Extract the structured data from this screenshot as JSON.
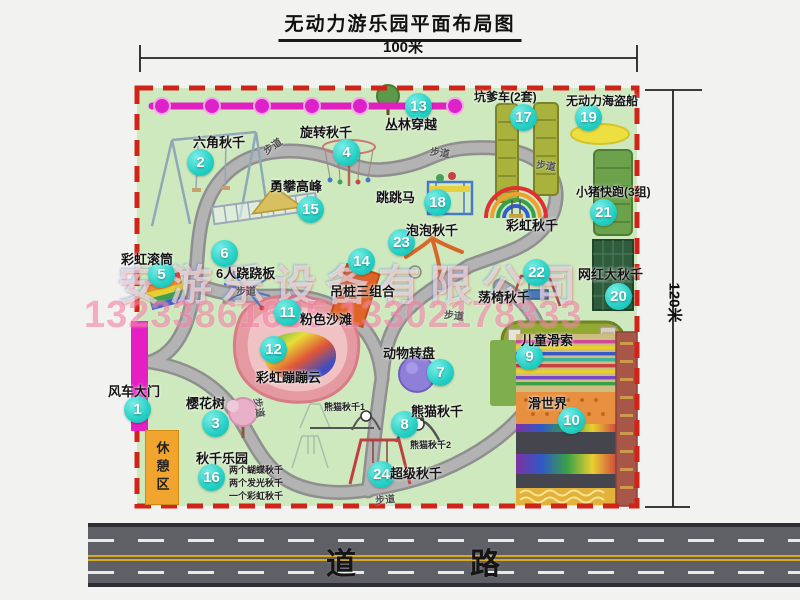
{
  "title": "无动力游乐园平面布局图",
  "dimensions": {
    "width": "100米",
    "height": "120米"
  },
  "road": {
    "label": "道　　路"
  },
  "rest_area": {
    "label": "休憩区"
  },
  "walkway_label": "步道",
  "watermark": {
    "company": "安游乐设备有限公司",
    "phone": "13233861635 13302178333"
  },
  "swing_park_notes": [
    "两个蝴蝶秋千",
    "两个发光秋千",
    "一个彩虹秋千"
  ],
  "panda_sub_labels": [
    "熊猫秋千1",
    "熊猫秋千2"
  ],
  "attractions": [
    {
      "num": "1",
      "name": "风车大门",
      "badge": [
        137,
        409
      ],
      "label": [
        108,
        381
      ]
    },
    {
      "num": "2",
      "name": "六角秋千",
      "badge": [
        200,
        162
      ],
      "label": [
        193,
        132
      ]
    },
    {
      "num": "3",
      "name": "樱花树",
      "badge": [
        215,
        423
      ],
      "label": [
        186,
        393
      ]
    },
    {
      "num": "4",
      "name": "旋转秋千",
      "badge": [
        346,
        152
      ],
      "label": [
        300,
        122
      ]
    },
    {
      "num": "5",
      "name": "彩虹滚筒",
      "badge": [
        161,
        274
      ],
      "label": [
        121,
        249
      ]
    },
    {
      "num": "6",
      "name": "6人跷跷板",
      "badge": [
        224,
        253
      ],
      "label": [
        216,
        263
      ]
    },
    {
      "num": "7",
      "name": "动物转盘",
      "badge": [
        440,
        372
      ],
      "label": [
        383,
        343
      ]
    },
    {
      "num": "8",
      "name": "熊猫秋千",
      "badge": [
        404,
        424
      ],
      "label": [
        411,
        401
      ]
    },
    {
      "num": "9",
      "name": "儿童滑索",
      "badge": [
        529,
        356
      ],
      "label": [
        521,
        330
      ]
    },
    {
      "num": "10",
      "name": "滑世界",
      "badge": [
        571,
        420
      ],
      "label": [
        528,
        393
      ]
    },
    {
      "num": "11",
      "name": "粉色沙滩",
      "badge": [
        287,
        312
      ],
      "label": [
        300,
        309
      ]
    },
    {
      "num": "12",
      "name": "彩虹蹦蹦云",
      "badge": [
        273,
        349
      ],
      "label": [
        256,
        367
      ]
    },
    {
      "num": "13",
      "name": "丛林穿越",
      "badge": [
        418,
        106
      ],
      "label": [
        385,
        114
      ]
    },
    {
      "num": "14",
      "name": "吊桩三组合",
      "badge": [
        361,
        261
      ],
      "label": [
        330,
        281
      ]
    },
    {
      "num": "15",
      "name": "勇攀高峰",
      "badge": [
        310,
        209
      ],
      "label": [
        270,
        176
      ]
    },
    {
      "num": "16",
      "name": "秋千乐园",
      "badge": [
        211,
        477
      ],
      "label": [
        196,
        448
      ]
    },
    {
      "num": "17",
      "name": "坑爹车(2套)",
      "badge": [
        523,
        117
      ],
      "label": [
        474,
        88
      ]
    },
    {
      "num": "18",
      "name": "跳跳马",
      "badge": [
        437,
        202
      ],
      "label": [
        376,
        187
      ]
    },
    {
      "num": "19",
      "name": "无动力海盗船",
      "badge": [
        588,
        117
      ],
      "label": [
        566,
        92
      ]
    },
    {
      "num": "20",
      "name": "网红大秋千",
      "badge": [
        618,
        296
      ],
      "label": [
        578,
        264
      ]
    },
    {
      "num": "21",
      "name": "小猪快跑(3组)",
      "badge": [
        603,
        212
      ],
      "label": [
        576,
        183
      ]
    },
    {
      "num": "22",
      "name": "荡椅秋千",
      "badge": [
        536,
        272
      ],
      "label": [
        478,
        287
      ]
    },
    {
      "num": "23",
      "name": "泡泡秋千",
      "badge": [
        401,
        242
      ],
      "label": [
        406,
        220
      ]
    },
    {
      "num": "24",
      "name": "超级秋千",
      "badge": [
        381,
        474
      ],
      "label": [
        390,
        463
      ]
    },
    {
      "num": "",
      "name": "彩虹秋千",
      "key": "rainbow-swing",
      "label": [
        506,
        215
      ]
    }
  ]
}
